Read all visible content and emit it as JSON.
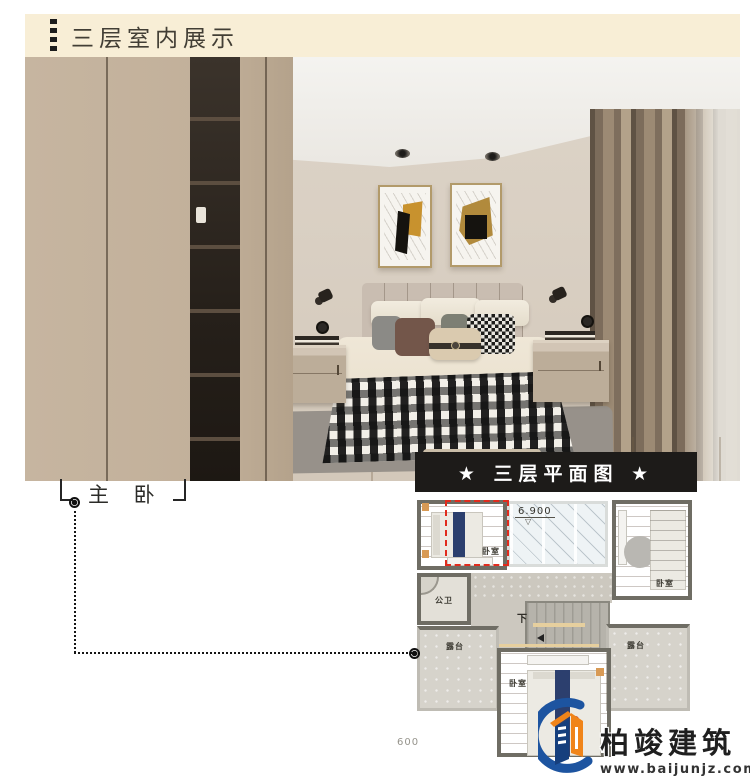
{
  "header": {
    "title": "三层室内展示"
  },
  "callout": {
    "label": "主 卧"
  },
  "floorplan": {
    "banner": "★ 三层平面图 ★",
    "elevation": "6.900",
    "elevation_triangle": "▽",
    "elevation_partial": "600",
    "stairs_label": "下",
    "rooms": {
      "bedroom_top_left": "卧室",
      "bedroom_right": "卧室",
      "bedroom_bottom": "卧室",
      "bathroom": "公卫",
      "terrace_left": "露台",
      "terrace_right": "露台"
    }
  },
  "logo": {
    "name": "柏竣建筑",
    "website": "www.baijunjz.com"
  },
  "colors": {
    "header_bg": "#f8eed6",
    "banner_bg": "#1d1b19",
    "highlight_red": "#e12b1d",
    "logo_blue": "#1d54a0",
    "logo_orange": "#f08419"
  }
}
